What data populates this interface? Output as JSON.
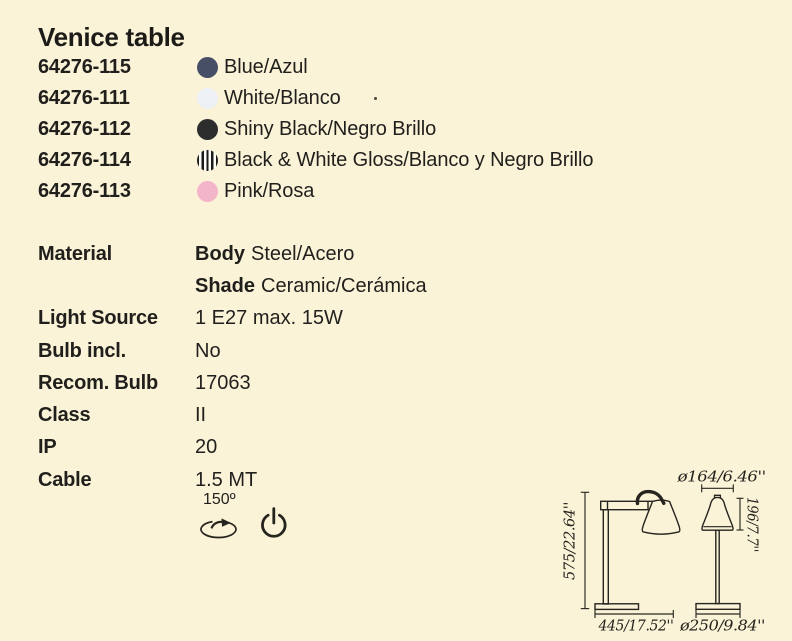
{
  "title": "Venice table",
  "colors": {
    "background": "#faf3d8",
    "text": "#201f1c",
    "drawing_line": "#26241e",
    "swatch_blue": "#474f66",
    "swatch_white": "#edf0f5",
    "swatch_black": "#2d2d2d",
    "swatch_pink": "#f3b5c9"
  },
  "products": [
    {
      "code": "64276-115",
      "name": "Blue/Azul",
      "swatch": "#474f66"
    },
    {
      "code": "64276-111",
      "name": "White/Blanco",
      "swatch": "#edf0f5"
    },
    {
      "code": "64276-112",
      "name": "Shiny Black/Negro Brillo",
      "swatch": "#2d2d2d"
    },
    {
      "code": "64276-114",
      "name": "Black & White Gloss/Blanco y Negro Brillo",
      "swatch": "striped"
    },
    {
      "code": "64276-113",
      "name": "Pink/Rosa",
      "swatch": "#f3b5c9"
    }
  ],
  "specs": [
    {
      "label": "Material",
      "value_bold": "Body",
      "value": "Steel/Acero"
    },
    {
      "label": "",
      "value_bold": "Shade",
      "value": "Ceramic/Cerámica"
    },
    {
      "label": "Light Source",
      "value_bold": "",
      "value": "1 E27 max. 15W"
    },
    {
      "label": "Bulb incl.",
      "value_bold": "",
      "value": "No"
    },
    {
      "label": "Recom. Bulb",
      "value_bold": "",
      "value": "17063"
    },
    {
      "label": "Class",
      "value_bold": "",
      "value": "II"
    },
    {
      "label": "IP",
      "value_bold": "",
      "value": "20"
    },
    {
      "label": "Cable",
      "value_bold": "",
      "value": "1.5 MT"
    }
  ],
  "features": {
    "rotation_angle": "150º",
    "rotation_icon": "rotation-arrow-icon",
    "power_icon": "power-symbol-icon"
  },
  "dimensions": {
    "height": "575/22.64''",
    "depth": "445/17.52''",
    "shade_diameter": "ø164/6.46''",
    "shade_height": "196/7.7''",
    "base_diameter": "ø250/9.84''"
  }
}
